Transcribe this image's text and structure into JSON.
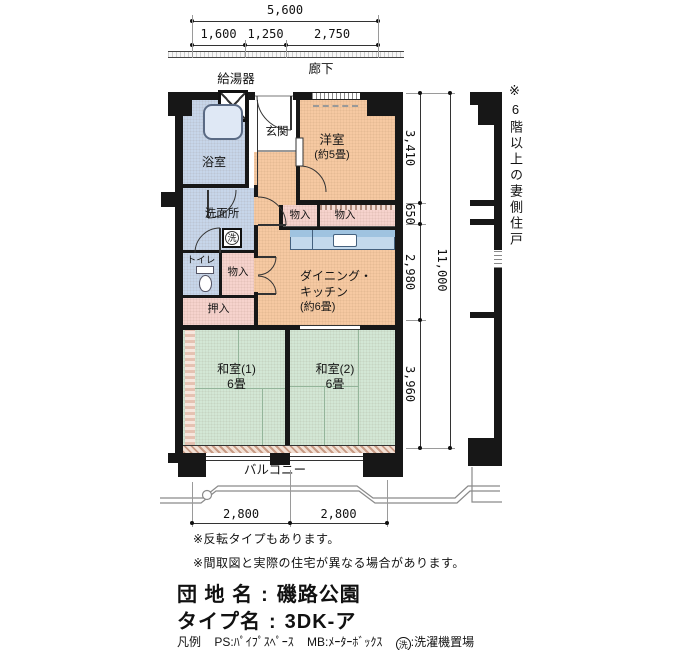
{
  "plan": {
    "corridor": "廊下",
    "water_heater": "給湯器",
    "entrance": "玄関",
    "western_room": {
      "name": "洋室",
      "size": "(約5畳)"
    },
    "bathroom": "浴室",
    "washroom": "洗面所",
    "toilet": "トイレ",
    "closet_west_left": "物入",
    "closet_west_right": "物入",
    "closet_hall": "物入",
    "oshiire": "押入",
    "dining_kitchen": {
      "line1": "ダイニング・",
      "line2": "キッチン",
      "size": "(約6畳)"
    },
    "japanese_room_1": {
      "name": "和室(1)",
      "size": "6畳"
    },
    "japanese_room_2": {
      "name": "和室(2)",
      "size": "6畳"
    },
    "balcony": "バルコニー",
    "washer_mark": "洗"
  },
  "dims": {
    "top": {
      "total": "5,600",
      "seg1": "1,600",
      "seg2": "1,250",
      "seg3": "2,750"
    },
    "right": {
      "total": "11,000",
      "seg1": "3,410",
      "seg2": "650",
      "seg3": "2,980",
      "seg4": "3,960"
    },
    "bottom": {
      "seg1": "2,800",
      "seg2": "2,800"
    }
  },
  "notes": {
    "gable": "※6階以上の妻側住戸",
    "reverse": "※反転タイプもあります。",
    "disclaimer": "※間取図と実際の住宅が異なる場合があります。"
  },
  "info": {
    "estate_label": "団 地 名",
    "estate_name": "磯路公園",
    "type_label": "タイプ名",
    "type_name": "3DK-ア",
    "colon": ":",
    "legend_label": "凡例",
    "legend_ps": "PS:ﾊﾟｲﾌﾟｽﾍﾟｰｽ",
    "legend_mb": "MB:ﾒｰﾀｰﾎﾞｯｸｽ",
    "legend_washer_mark": "洗",
    "legend_washer_text": ":洗濯機置場"
  },
  "colors": {
    "wall": "#171717",
    "room_warm": "#f6c9a2",
    "room_wet": "#c7d6ea",
    "closet_pink": "#f6d3cd",
    "tatami_green": "#d3e7d5",
    "counter_blue": "#c3d9ec"
  }
}
